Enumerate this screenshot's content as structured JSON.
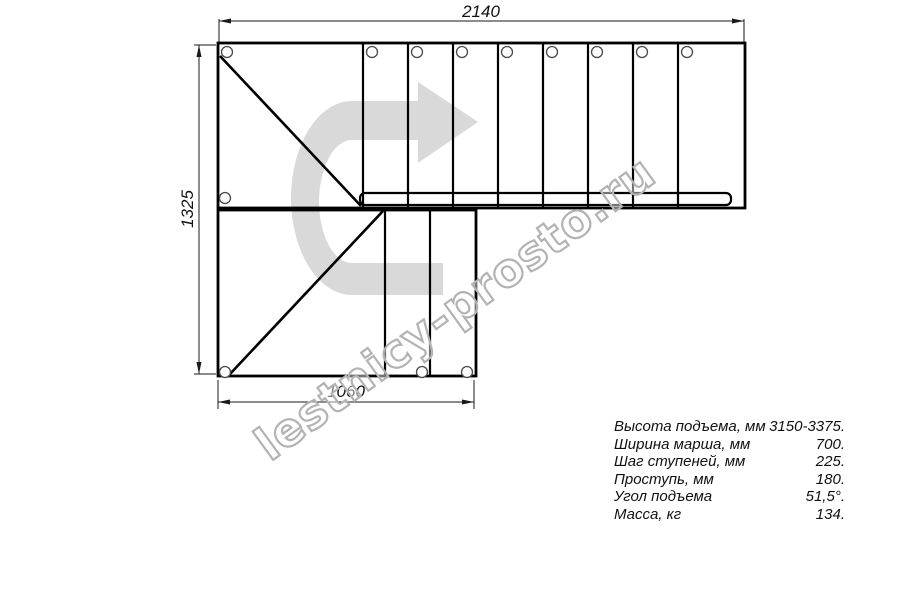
{
  "drawing": {
    "title": "L-shaped staircase plan",
    "watermark_text": "lestnicy-prosto.ru",
    "direction_arrow": "u-turn-right-arrow",
    "dimensions": {
      "top_width": "2140",
      "left_height": "1325",
      "bottom_width": "1060"
    },
    "specs": {
      "rows": [
        {
          "label": "Высота подъема, мм",
          "value": "3150-3375."
        },
        {
          "label": "Ширина марша, мм",
          "value": "700."
        },
        {
          "label": "Шаг ступеней, мм",
          "value": "225."
        },
        {
          "label": "Проступь, мм",
          "value": "180."
        },
        {
          "label": "Угол подъема",
          "value": "51,5°."
        },
        {
          "label": "Масса, кг",
          "value": "134."
        }
      ]
    },
    "colors": {
      "background": "#ffffff",
      "line": "#000000",
      "dimension_line": "#1a1a1a",
      "arrow_fill": "#d9d9d9",
      "watermark_stroke": "#b3b3b3"
    }
  }
}
